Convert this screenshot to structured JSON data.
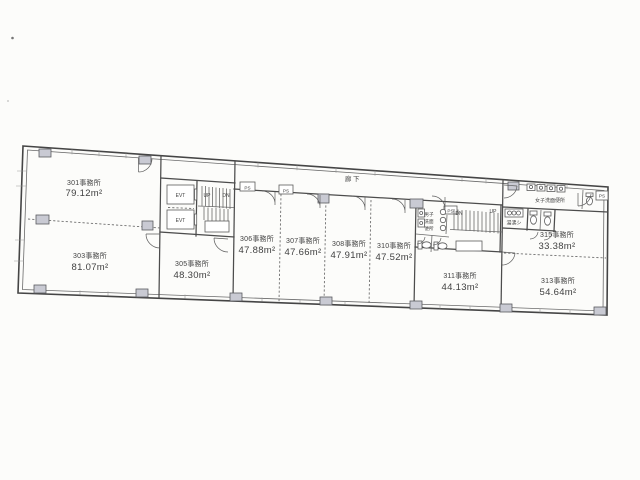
{
  "floor_plan": {
    "corridor_label": "廊下",
    "rooms": [
      {
        "number": "301",
        "name": "301事務所",
        "area": "79.12m²"
      },
      {
        "number": "303",
        "name": "303事務所",
        "area": "81.07m²"
      },
      {
        "number": "305",
        "name": "305事務所",
        "area": "48.30m²"
      },
      {
        "number": "306",
        "name": "306事務所",
        "area": "47.88m²"
      },
      {
        "number": "307",
        "name": "307事務所",
        "area": "47.66m²"
      },
      {
        "number": "308",
        "name": "308事務所",
        "area": "47.91m²"
      },
      {
        "number": "310",
        "name": "310事務所",
        "area": "47.52m²"
      },
      {
        "number": "311",
        "name": "311事務所",
        "area": "44.13m²"
      },
      {
        "number": "313",
        "name": "313事務所",
        "area": "54.64m²"
      },
      {
        "number": "315",
        "name": "315事務所",
        "area": "33.38m²"
      }
    ],
    "elevators": {
      "label": "EVT"
    },
    "stairs_left": {
      "up": "UP",
      "down": "DN"
    },
    "stairs_right": {
      "up": "UP",
      "down": "DN"
    },
    "pipe_shaft_label": "PS",
    "mens_restroom": {
      "line1": "男子",
      "line2": "洗面",
      "line3": "便所"
    },
    "womens_restroom_label": "女子洗面便所",
    "kitchenette_label": "湯沸シ"
  },
  "colors": {
    "paper": "#fcfcfa",
    "wall_line": "#4c4c4c",
    "column_fill": "#c9cad3",
    "text": "#414141"
  }
}
